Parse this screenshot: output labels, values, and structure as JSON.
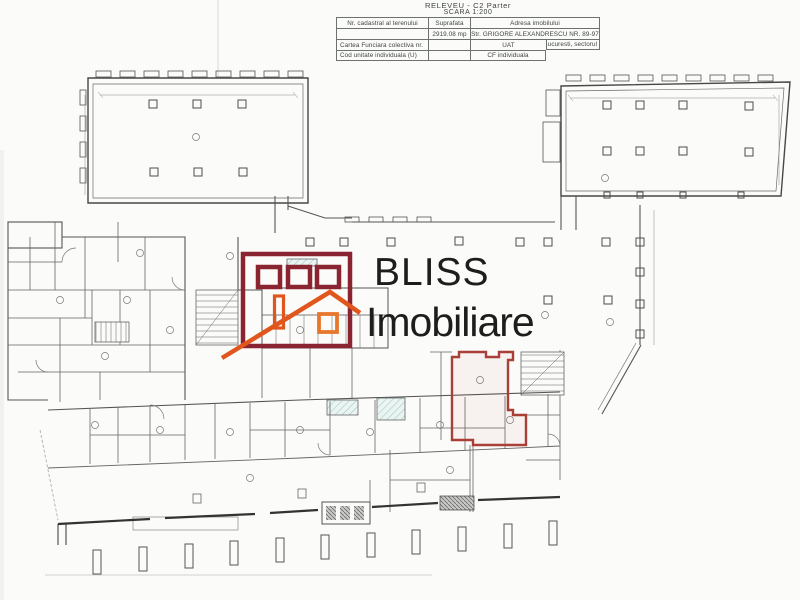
{
  "header": {
    "title_line1": "RELEVEU - C2 Parter",
    "title_line2": "SCARA 1:200",
    "table": {
      "r1c1": "Nr. cadastral al terenului",
      "r1c2": "Suprafata",
      "r1c3": "Adresa imobilului",
      "r2c1": "",
      "r2c2": "2919.08 mp",
      "r2c3": "Str. GRIGORE ALEXANDRESCU NR. 89-97",
      "r3c1": "Cartea Funciara colectiva nr.",
      "r3c2": "",
      "r3c3": "UAT",
      "r3c4": "Bucuresti, sectorul 1",
      "r4c1": "Cod unitate individuala (U)",
      "r4c2": "",
      "r4c3": "CF individuala"
    }
  },
  "watermark": {
    "line1": "BLISS",
    "line2": "Imobiliare",
    "colors": {
      "house_maroon": "#8b2431",
      "roof_orange": "#e1561c",
      "window_orange": "#e8772e",
      "text": "#1d1d1c"
    }
  },
  "plan": {
    "highlighted_unit_color": "#a84038",
    "wall_color": "#474747",
    "stair_hatch_color": "#9dc4be"
  }
}
